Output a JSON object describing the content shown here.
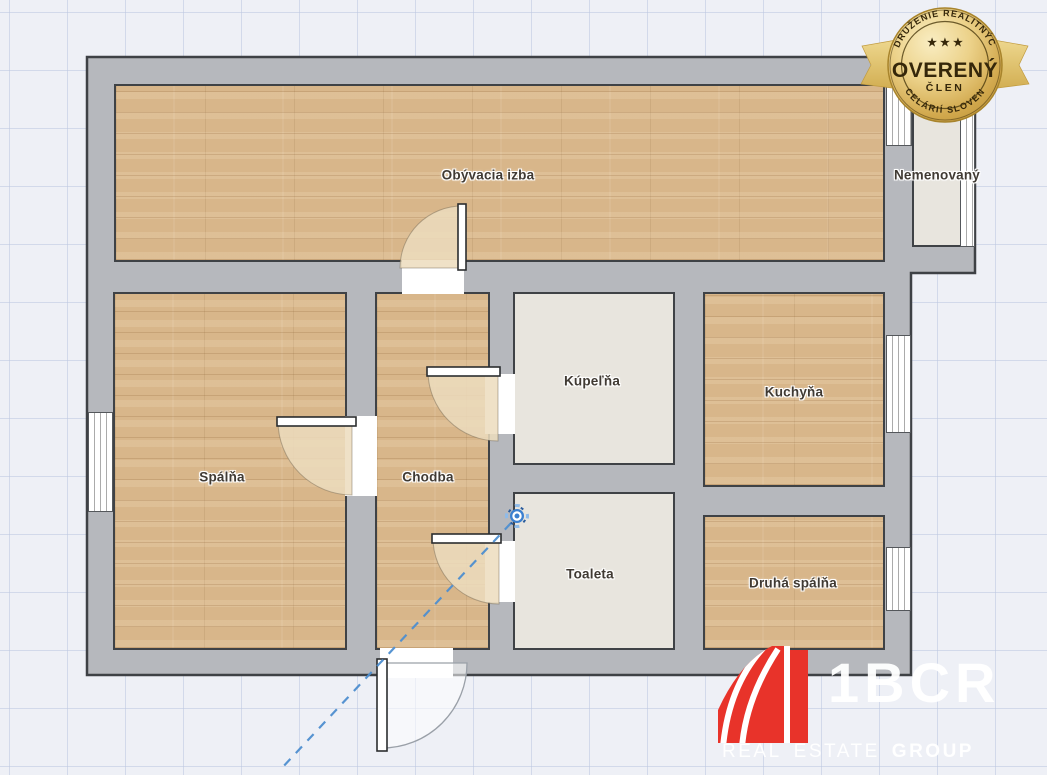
{
  "plan": {
    "rooms": {
      "living_room": {
        "label": "Obývacia izba"
      },
      "unnamed": {
        "label": "Nemenovaný"
      },
      "bedroom": {
        "label": "Spálňa"
      },
      "hallway": {
        "label": "Chodba"
      },
      "bathroom": {
        "label": "Kúpeľňa"
      },
      "kitchen": {
        "label": "Kuchyňa"
      },
      "toilet": {
        "label": "Toaleta"
      },
      "second_bedroom": {
        "label": "Druhá spálňa"
      }
    }
  },
  "badge": {
    "arc_top": "ZDRUŽENIE REALITNÝCH",
    "arc_bottom": "KANCELÁRIÍ SLOVENSKA",
    "stars": "★ ★ ★",
    "title": "OVERENÝ",
    "subtitle": "ČLEN"
  },
  "logo": {
    "name": "1BCR",
    "word_real": "REAL",
    "word_estate": "ESTATE",
    "word_group": "GROUP"
  },
  "icons": {
    "panorama_marker": "360-panorama-view-icon"
  },
  "colors": {
    "wall": "#b6b8bd",
    "wall_outline": "#3f4246",
    "wood_floor": "#d8b68a",
    "tile_floor": "#e8e5de",
    "logo_red": "#e8332a",
    "badge_gold": "#d9b35a",
    "marker_blue": "#3c80cf",
    "path_blue": "#4e8fd0"
  }
}
